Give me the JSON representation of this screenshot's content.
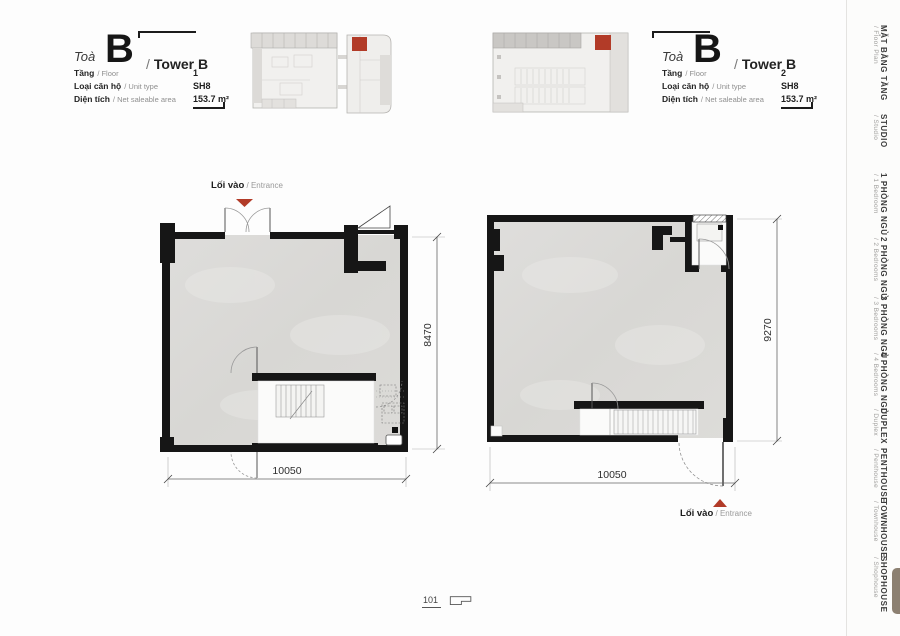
{
  "colors": {
    "accent_red": "#b23b28",
    "wall_black": "#161616",
    "floor_gray": "#dcdbd8",
    "active_tab_brown": "#8c8071"
  },
  "page_number": "101",
  "headers": [
    {
      "toa": "Toà",
      "letter": "B",
      "slash": "/",
      "name": "Tower B",
      "rows": [
        {
          "label": "Tầng",
          "sub": "/ Floor",
          "value": "1"
        },
        {
          "label": "Loại căn hộ",
          "sub": "/ Unit type",
          "value": "SH8"
        },
        {
          "label": "Diện tích",
          "sub": "/ Net saleable area",
          "value": "153.7 m²"
        }
      ]
    },
    {
      "toa": "Toà",
      "letter": "B",
      "slash": "/",
      "name": "Tower B",
      "rows": [
        {
          "label": "Tầng",
          "sub": "/ Floor",
          "value": "2"
        },
        {
          "label": "Loại căn hộ",
          "sub": "/ Unit type",
          "value": "SH8"
        },
        {
          "label": "Diện tích",
          "sub": "/ Net saleable area",
          "value": "153.7 m²"
        }
      ]
    }
  ],
  "plans": [
    {
      "entrance_vi": "Lối vào",
      "entrance_en": "/ Entrance",
      "width_dim": "10050",
      "height_dim": "8470"
    },
    {
      "entrance_vi": "Lối vào",
      "entrance_en": "/ Entrance",
      "width_dim": "10050",
      "height_dim": "9270"
    }
  ],
  "sidebar": {
    "active_item": "SHOPHOUSE",
    "items": [
      {
        "vi": "MẶT BẰNG TẦNG",
        "en": "/ Floor Plan"
      },
      {
        "vi": "STUDIO",
        "en": "/ Studio"
      },
      {
        "vi": "1 PHÒNG NGỦ",
        "en": "/ 1 Bedroom"
      },
      {
        "vi": "2 PHÒNG NGỦ",
        "en": "/ 2 Bedrooms"
      },
      {
        "vi": "3 PHÒNG NGỦ",
        "en": "/ 3 Bedrooms"
      },
      {
        "vi": "4 PHÒNG NGỦ",
        "en": "/ 4 Bedrooms"
      },
      {
        "vi": "DUPLEX",
        "en": "/ Duplex"
      },
      {
        "vi": "PENTHOUSE",
        "en": "/ Penthouse"
      },
      {
        "vi": "TOWNHOUSE",
        "en": "/ Townhouse"
      },
      {
        "vi": "SHOPHOUSE",
        "en": "/ Shophouse"
      }
    ]
  }
}
